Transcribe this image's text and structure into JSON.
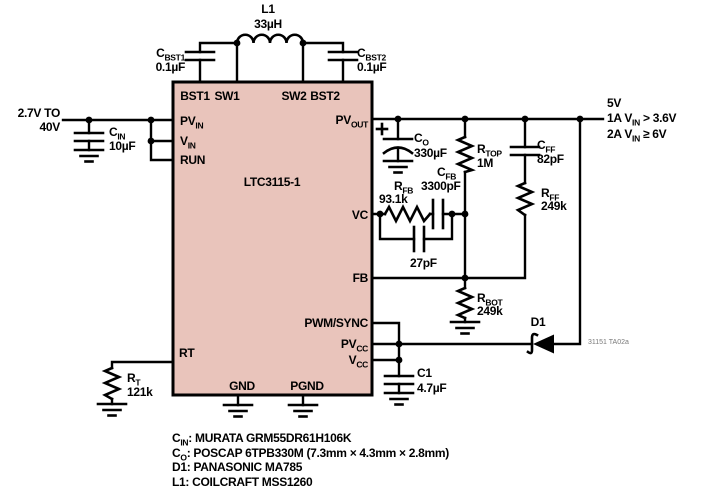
{
  "ic": {
    "name": "LTC3115-1"
  },
  "colors": {
    "ic_fill": "#e9c4bb",
    "wire": "#000000",
    "fig_label": "#7a7a7a"
  },
  "pins": {
    "bst1": "BST1",
    "sw1": "SW1",
    "sw2": "SW2",
    "bst2": "BST2",
    "pvin": {
      "main": "PV",
      "sub": "IN"
    },
    "vin": {
      "main": "V",
      "sub": "IN"
    },
    "run": "RUN",
    "pvout": {
      "main": "PV",
      "sub": "OUT"
    },
    "vc": "VC",
    "fb": "FB",
    "pwmsync": "PWM/SYNC",
    "pvcc": {
      "main": "PV",
      "sub": "CC"
    },
    "vcc": {
      "main": "V",
      "sub": "CC"
    },
    "rt": "RT",
    "gnd": "GND",
    "pgnd": "PGND"
  },
  "components": {
    "l1": {
      "ref": "L1",
      "value": "33µH"
    },
    "cbst1": {
      "ref": "C",
      "sub": "BST1",
      "value": "0.1µF"
    },
    "cbst2": {
      "ref": "C",
      "sub": "BST2",
      "value": "0.1µF"
    },
    "cin": {
      "ref": "C",
      "sub": "IN",
      "value": "10µF"
    },
    "co": {
      "ref": "C",
      "sub": "O",
      "value": "330µF"
    },
    "rtop": {
      "ref": "R",
      "sub": "TOP",
      "value": "1M"
    },
    "cff": {
      "ref": "C",
      "sub": "FF",
      "value": "82pF"
    },
    "rff": {
      "ref": "R",
      "sub": "FF",
      "value": "249k"
    },
    "rfb": {
      "ref": "R",
      "sub": "FB",
      "value": "93.1k"
    },
    "cfb": {
      "ref": "C",
      "sub": "FB",
      "value": "3300pF"
    },
    "c27": {
      "value": "27pF"
    },
    "rbot": {
      "ref": "R",
      "sub": "BOT",
      "value": "249k"
    },
    "d1": {
      "ref": "D1"
    },
    "c1": {
      "ref": "C1",
      "value": "4.7µF"
    },
    "rt": {
      "ref": "R",
      "sub": "T",
      "value": "121k"
    }
  },
  "input": {
    "line1": "2.7V TO",
    "line2": "40V"
  },
  "output": {
    "line1": "5V",
    "line2": {
      "pre": "1A V",
      "sub": "IN",
      "post": " > 3.6V"
    },
    "line3": {
      "pre": "2A V",
      "sub": "IN",
      "post": " ≥ 6V"
    }
  },
  "notes": [
    {
      "pre": "C",
      "sub": "IN",
      "post": ": MURATA GRM55DR61H106K"
    },
    {
      "pre": "C",
      "sub": "O",
      "post": ": POSCAP 6TPB330M (7.3mm × 4.3mm × 2.8mm)"
    },
    {
      "pre": "D1: PANASONIC MA785",
      "sub": "",
      "post": ""
    },
    {
      "pre": "L1: COILCRAFT MSS1260",
      "sub": "",
      "post": ""
    }
  ],
  "fig_label": "31151 TA02a"
}
